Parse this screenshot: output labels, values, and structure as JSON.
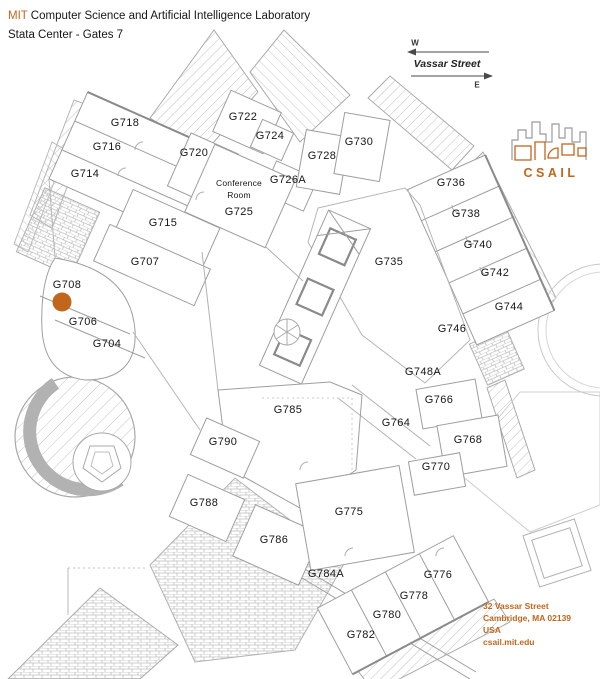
{
  "colors": {
    "accent": "#c2661c",
    "line": "#9e9e9e"
  },
  "header": {
    "brand": "MIT",
    "title": "Computer Science and Artificial Intelligence Laboratory",
    "subtitle": "Stata Center - Gates 7"
  },
  "compass": {
    "west": "W",
    "east": "E",
    "street": "Vassar Street"
  },
  "logo": {
    "text": "CSAIL"
  },
  "address": {
    "lines": [
      "32 Vassar Street",
      "Cambridge, MA 02139",
      "USA",
      "csail.mit.edu"
    ]
  },
  "map": {
    "marker": {
      "room": "G708",
      "x": 62,
      "y": 302
    },
    "labels": [
      {
        "label": "G718",
        "x": 125,
        "y": 123
      },
      {
        "label": "G716",
        "x": 107,
        "y": 147
      },
      {
        "label": "G714",
        "x": 85,
        "y": 174
      },
      {
        "label": "G720",
        "x": 194,
        "y": 153
      },
      {
        "label": "G722",
        "x": 243,
        "y": 117
      },
      {
        "label": "G724",
        "x": 270,
        "y": 136
      },
      {
        "label": "Conference",
        "x": 239,
        "y": 183,
        "small": true
      },
      {
        "label": "Room",
        "x": 239,
        "y": 195,
        "small": true
      },
      {
        "label": "G725",
        "x": 239,
        "y": 212
      },
      {
        "label": "G726A",
        "x": 288,
        "y": 180
      },
      {
        "label": "G728",
        "x": 322,
        "y": 156
      },
      {
        "label": "G730",
        "x": 359,
        "y": 142
      },
      {
        "label": "G736",
        "x": 451,
        "y": 183
      },
      {
        "label": "G738",
        "x": 466,
        "y": 214
      },
      {
        "label": "G740",
        "x": 478,
        "y": 245
      },
      {
        "label": "G742",
        "x": 495,
        "y": 273
      },
      {
        "label": "G744",
        "x": 509,
        "y": 307
      },
      {
        "label": "G735",
        "x": 389,
        "y": 262
      },
      {
        "label": "G746",
        "x": 452,
        "y": 329
      },
      {
        "label": "G715",
        "x": 163,
        "y": 223
      },
      {
        "label": "G707",
        "x": 145,
        "y": 262
      },
      {
        "label": "G708",
        "x": 67,
        "y": 285
      },
      {
        "label": "G706",
        "x": 83,
        "y": 322
      },
      {
        "label": "G704",
        "x": 107,
        "y": 344
      },
      {
        "label": "G748A",
        "x": 423,
        "y": 372
      },
      {
        "label": "G766",
        "x": 439,
        "y": 400
      },
      {
        "label": "G764",
        "x": 396,
        "y": 423
      },
      {
        "label": "G768",
        "x": 468,
        "y": 440
      },
      {
        "label": "G770",
        "x": 436,
        "y": 467
      },
      {
        "label": "G785",
        "x": 288,
        "y": 410
      },
      {
        "label": "G790",
        "x": 223,
        "y": 442
      },
      {
        "label": "G788",
        "x": 204,
        "y": 503
      },
      {
        "label": "G786",
        "x": 274,
        "y": 540
      },
      {
        "label": "G775",
        "x": 349,
        "y": 512
      },
      {
        "label": "G784A",
        "x": 326,
        "y": 574
      },
      {
        "label": "G776",
        "x": 438,
        "y": 575
      },
      {
        "label": "G778",
        "x": 414,
        "y": 596
      },
      {
        "label": "G780",
        "x": 387,
        "y": 615
      },
      {
        "label": "G782",
        "x": 361,
        "y": 635
      }
    ]
  }
}
